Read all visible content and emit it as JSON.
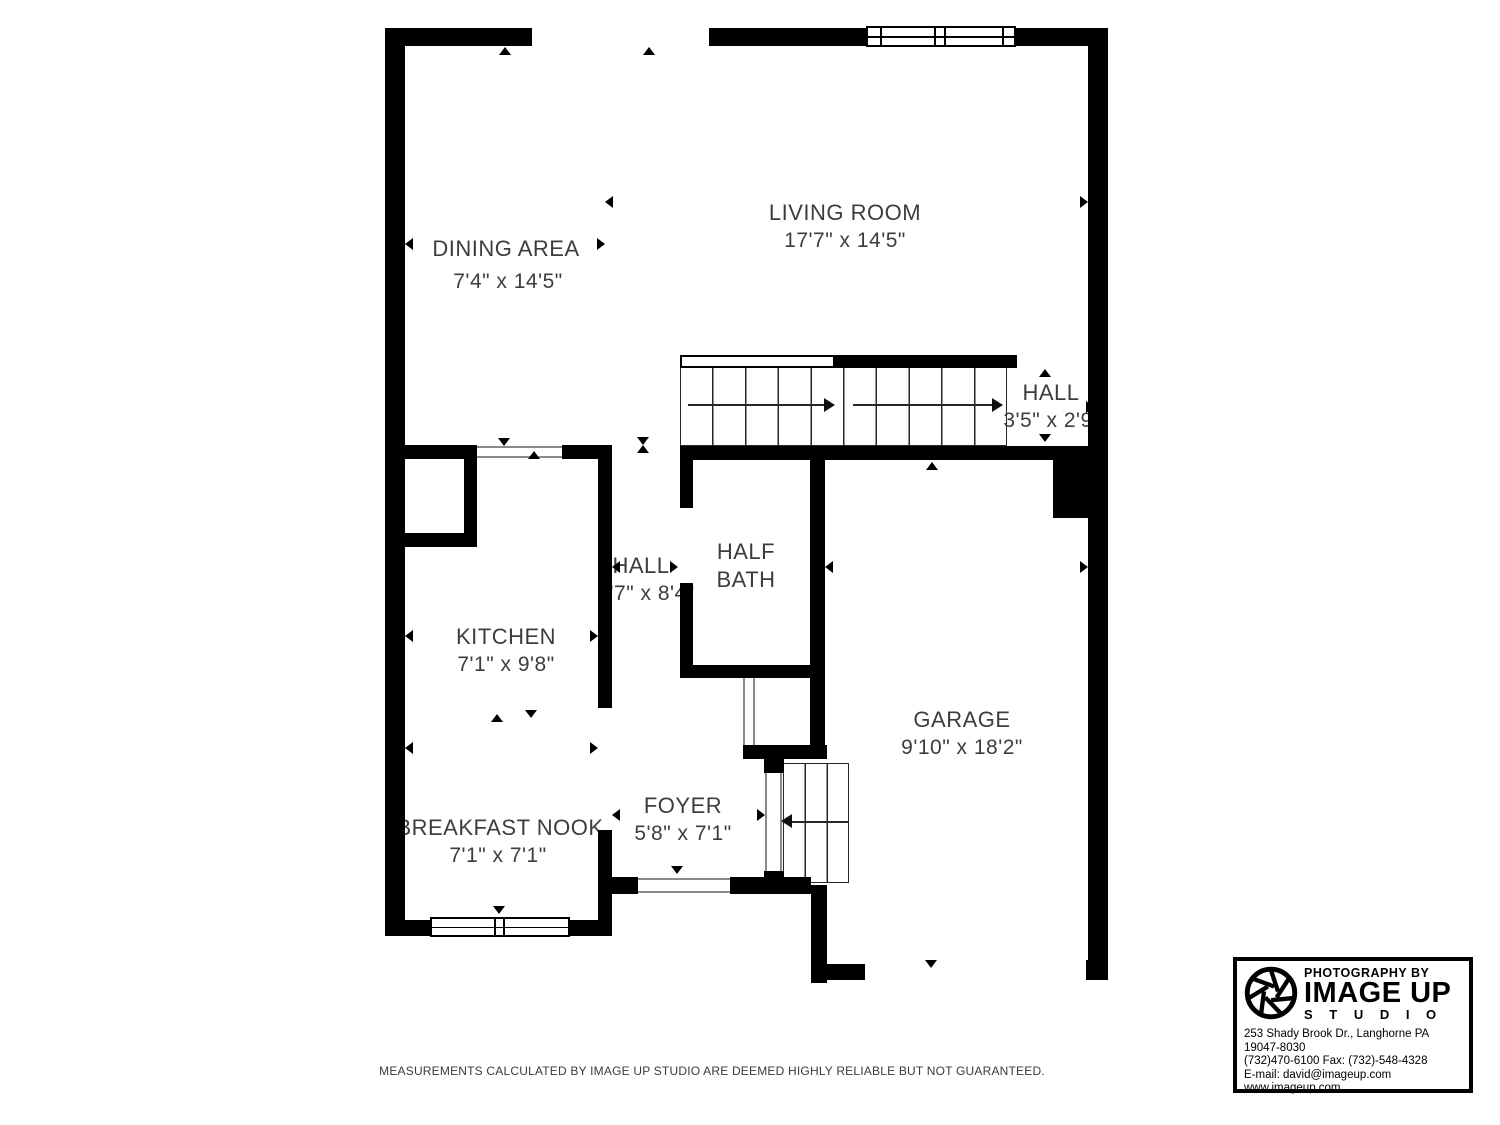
{
  "colors": {
    "wall": "#000000",
    "label": "#3d3d3d",
    "stair_line": "#262626",
    "door_line": "#8a8a8a"
  },
  "rooms": {
    "dining": {
      "name": "DINING AREA",
      "dims": "7'4\" x 14'5\""
    },
    "living": {
      "name": "LIVING ROOM",
      "dims": "17'7\" x 14'5\""
    },
    "hall_upper": {
      "name": "HALL",
      "dims": "3'5\" x 2'9\""
    },
    "kitchen": {
      "name": "KITCHEN",
      "dims": "7'1\" x 9'8\""
    },
    "hall": {
      "name": "HALL",
      "dims": "2'7\" x 8'4\""
    },
    "half_bath": {
      "line1": "HALF",
      "line2": "BATH"
    },
    "garage": {
      "name": "GARAGE",
      "dims": "9'10\" x 18'2\""
    },
    "foyer": {
      "name": "FOYER",
      "dims": "5'8\" x 7'1\""
    },
    "breakfast_nook": {
      "name": "BREAKFAST NOOK",
      "dims": "7'1\" x 7'1\""
    }
  },
  "footer": {
    "disclaimer": "MEASUREMENTS CALCULATED BY IMAGE UP STUDIO ARE DEEMED HIGHLY RELIABLE BUT NOT GUARANTEED."
  },
  "logo": {
    "tagline": "PHOTOGRAPHY BY",
    "brand": "IMAGE UP",
    "sub": "S T U D I O",
    "address": "253 Shady Brook Dr., Langhorne PA 19047-8030",
    "phone": "(732)470-6100 Fax: (732)-548-4328",
    "email": "E-mail: david@imageup.com",
    "web": "www.imageup.com"
  }
}
